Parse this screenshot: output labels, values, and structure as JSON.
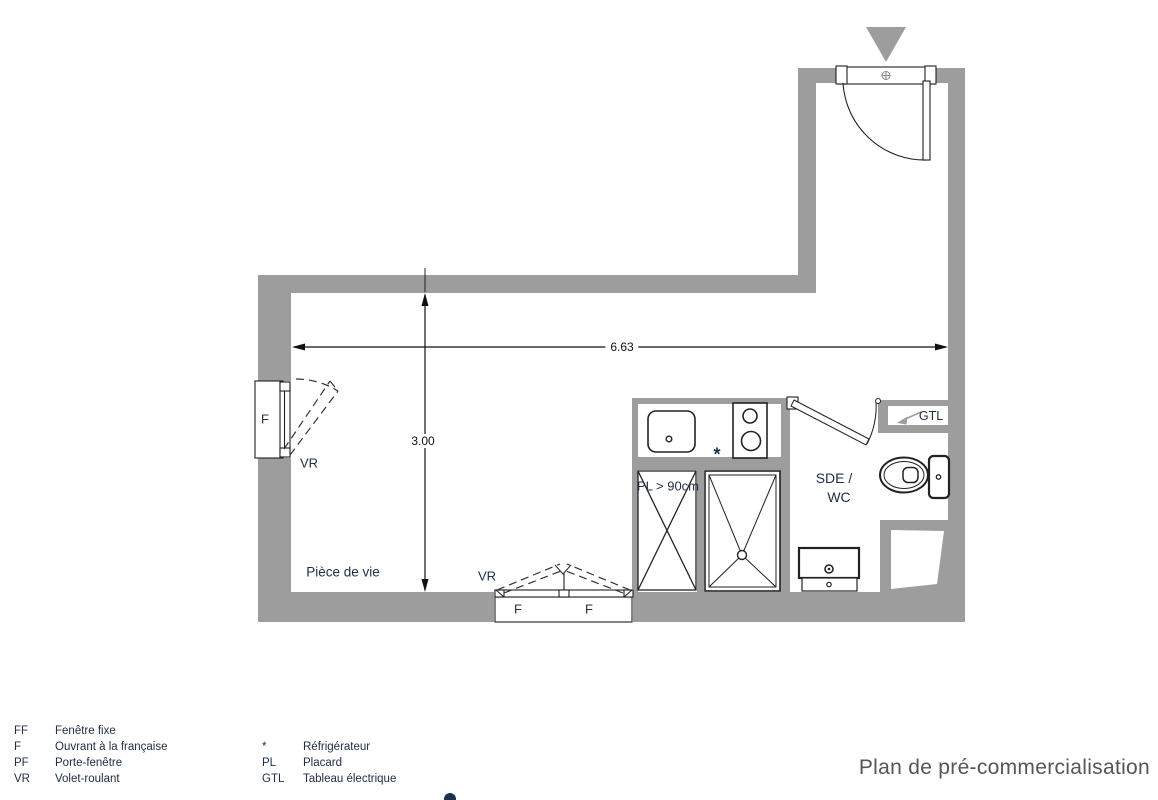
{
  "title": {
    "text": "Plan de pré-commercialisation"
  },
  "plan": {
    "room_label": "Pièce de vie",
    "bathroom_label_line1": "SDE /",
    "bathroom_label_line2": "WC",
    "closet_label": "PL > 90cm",
    "electrical_label": "GTL",
    "fridge_marker": "*",
    "window_left": {
      "type_label": "F",
      "shutter_label": "VR"
    },
    "window_bottom": {
      "type_label_1": "F",
      "type_label_2": "F",
      "shutter_label": "VR"
    },
    "dimensions": {
      "width_m": "6.63",
      "height_m": "3.00"
    }
  },
  "legend": {
    "col1": [
      {
        "abbr": "FF",
        "label": "Fenêtre fixe"
      },
      {
        "abbr": "F",
        "label": "Ouvrant à la française"
      },
      {
        "abbr": "PF",
        "label": "Porte-fenêtre"
      },
      {
        "abbr": "VR",
        "label": "Volet-roulant"
      }
    ],
    "col2": [
      {
        "abbr": "*",
        "label": "Réfrigérateur"
      },
      {
        "abbr": "PL",
        "label": "Placard"
      },
      {
        "abbr": "GTL",
        "label": "Tableau électrique"
      }
    ]
  },
  "colors": {
    "wall": "#9d9d9d",
    "line": "#1f1f1f",
    "label": "#203044",
    "title": "#52555c"
  }
}
